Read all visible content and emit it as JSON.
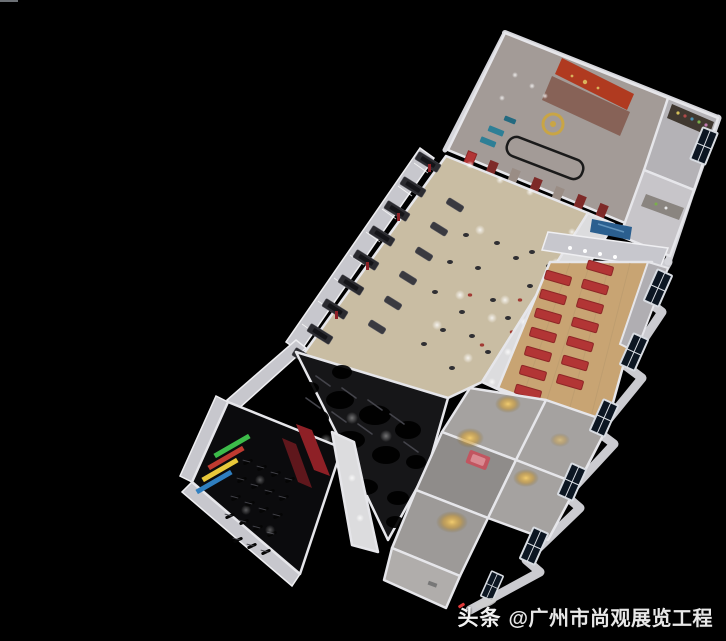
{
  "watermark": {
    "brand": "头条",
    "handle": "@广州市尚观展览工程"
  },
  "palette": {
    "bg": "#000000",
    "wall": "#e6e6ea",
    "wallShade": "#c7c7cd",
    "receptionFloor": "#a39b97",
    "featureWall": "#b03a20",
    "gold": "#c9a545",
    "sofaBlue": "#2e7f96",
    "cabinetRed": "#7e2a28",
    "annexFloor": "#b4b2b6",
    "shelfDark": "#403830",
    "carpetBeige": "#c9bda3",
    "equipmentDark": "#2b2b30",
    "pillarRed": "#8e2026",
    "woodFloor": "#c8a473",
    "matRed": "#b23535",
    "screenBlue": "#2b5f8f",
    "grayRoom": "#a5a2a0",
    "darkZone": "#161618",
    "spinFloor": "#0b0b0d",
    "neonGreen": "#3dbb4a",
    "neonRed": "#c03a30",
    "neonYellow": "#e8c83a",
    "neonBlue": "#2f7fc0",
    "glowGold": "#e8b84a",
    "bedRed": "#c25560",
    "windowGlass": "#0c1622",
    "windowFrame": "#d8dce2",
    "walkway": "#dcdcde",
    "watermarkText": "#f2f2f2",
    "watermarkAccent": "#e03a3a"
  }
}
